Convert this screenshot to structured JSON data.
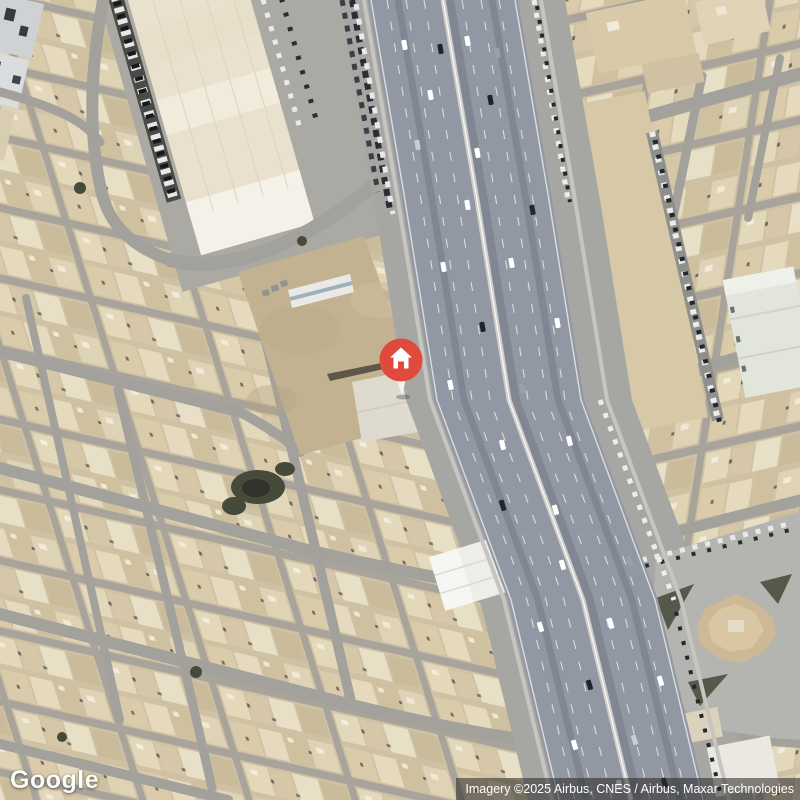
{
  "app": {
    "name": "Google Maps satellite screenshot"
  },
  "map": {
    "view_type": "satellite",
    "logo": {
      "text": "Google"
    },
    "attribution": {
      "text": "Imagery ©2025 Airbus, CNES / Airbus, Maxar Technologies"
    },
    "marker": {
      "name": "home-marker",
      "icon": "house",
      "color": "#E04A3C",
      "stem_color": "#F4F2EE",
      "icon_color": "#FFFFFF",
      "x": 401,
      "y": 360
    },
    "palette": {
      "sand": "#CFC1A3",
      "building_light": "#E6DCC2",
      "building_mid": "#D6C8A8",
      "street": "#A8A49C",
      "highway_asphalt": "#9298A3",
      "frontage": "#A6A6A2",
      "median": "#CFCEC9",
      "lane_line": "#E9E9E6",
      "deep_shadow": "#232C3A",
      "white_roof": "#F0EBDD",
      "mall_roof": "#E9E1CD",
      "dirt_lot": "#C2B292",
      "tree": "#454A39",
      "plaza": "#B4B4B0",
      "attribution_bg": "rgba(38,38,38,0.55)",
      "watermark_text": "#FFFFFF"
    }
  }
}
